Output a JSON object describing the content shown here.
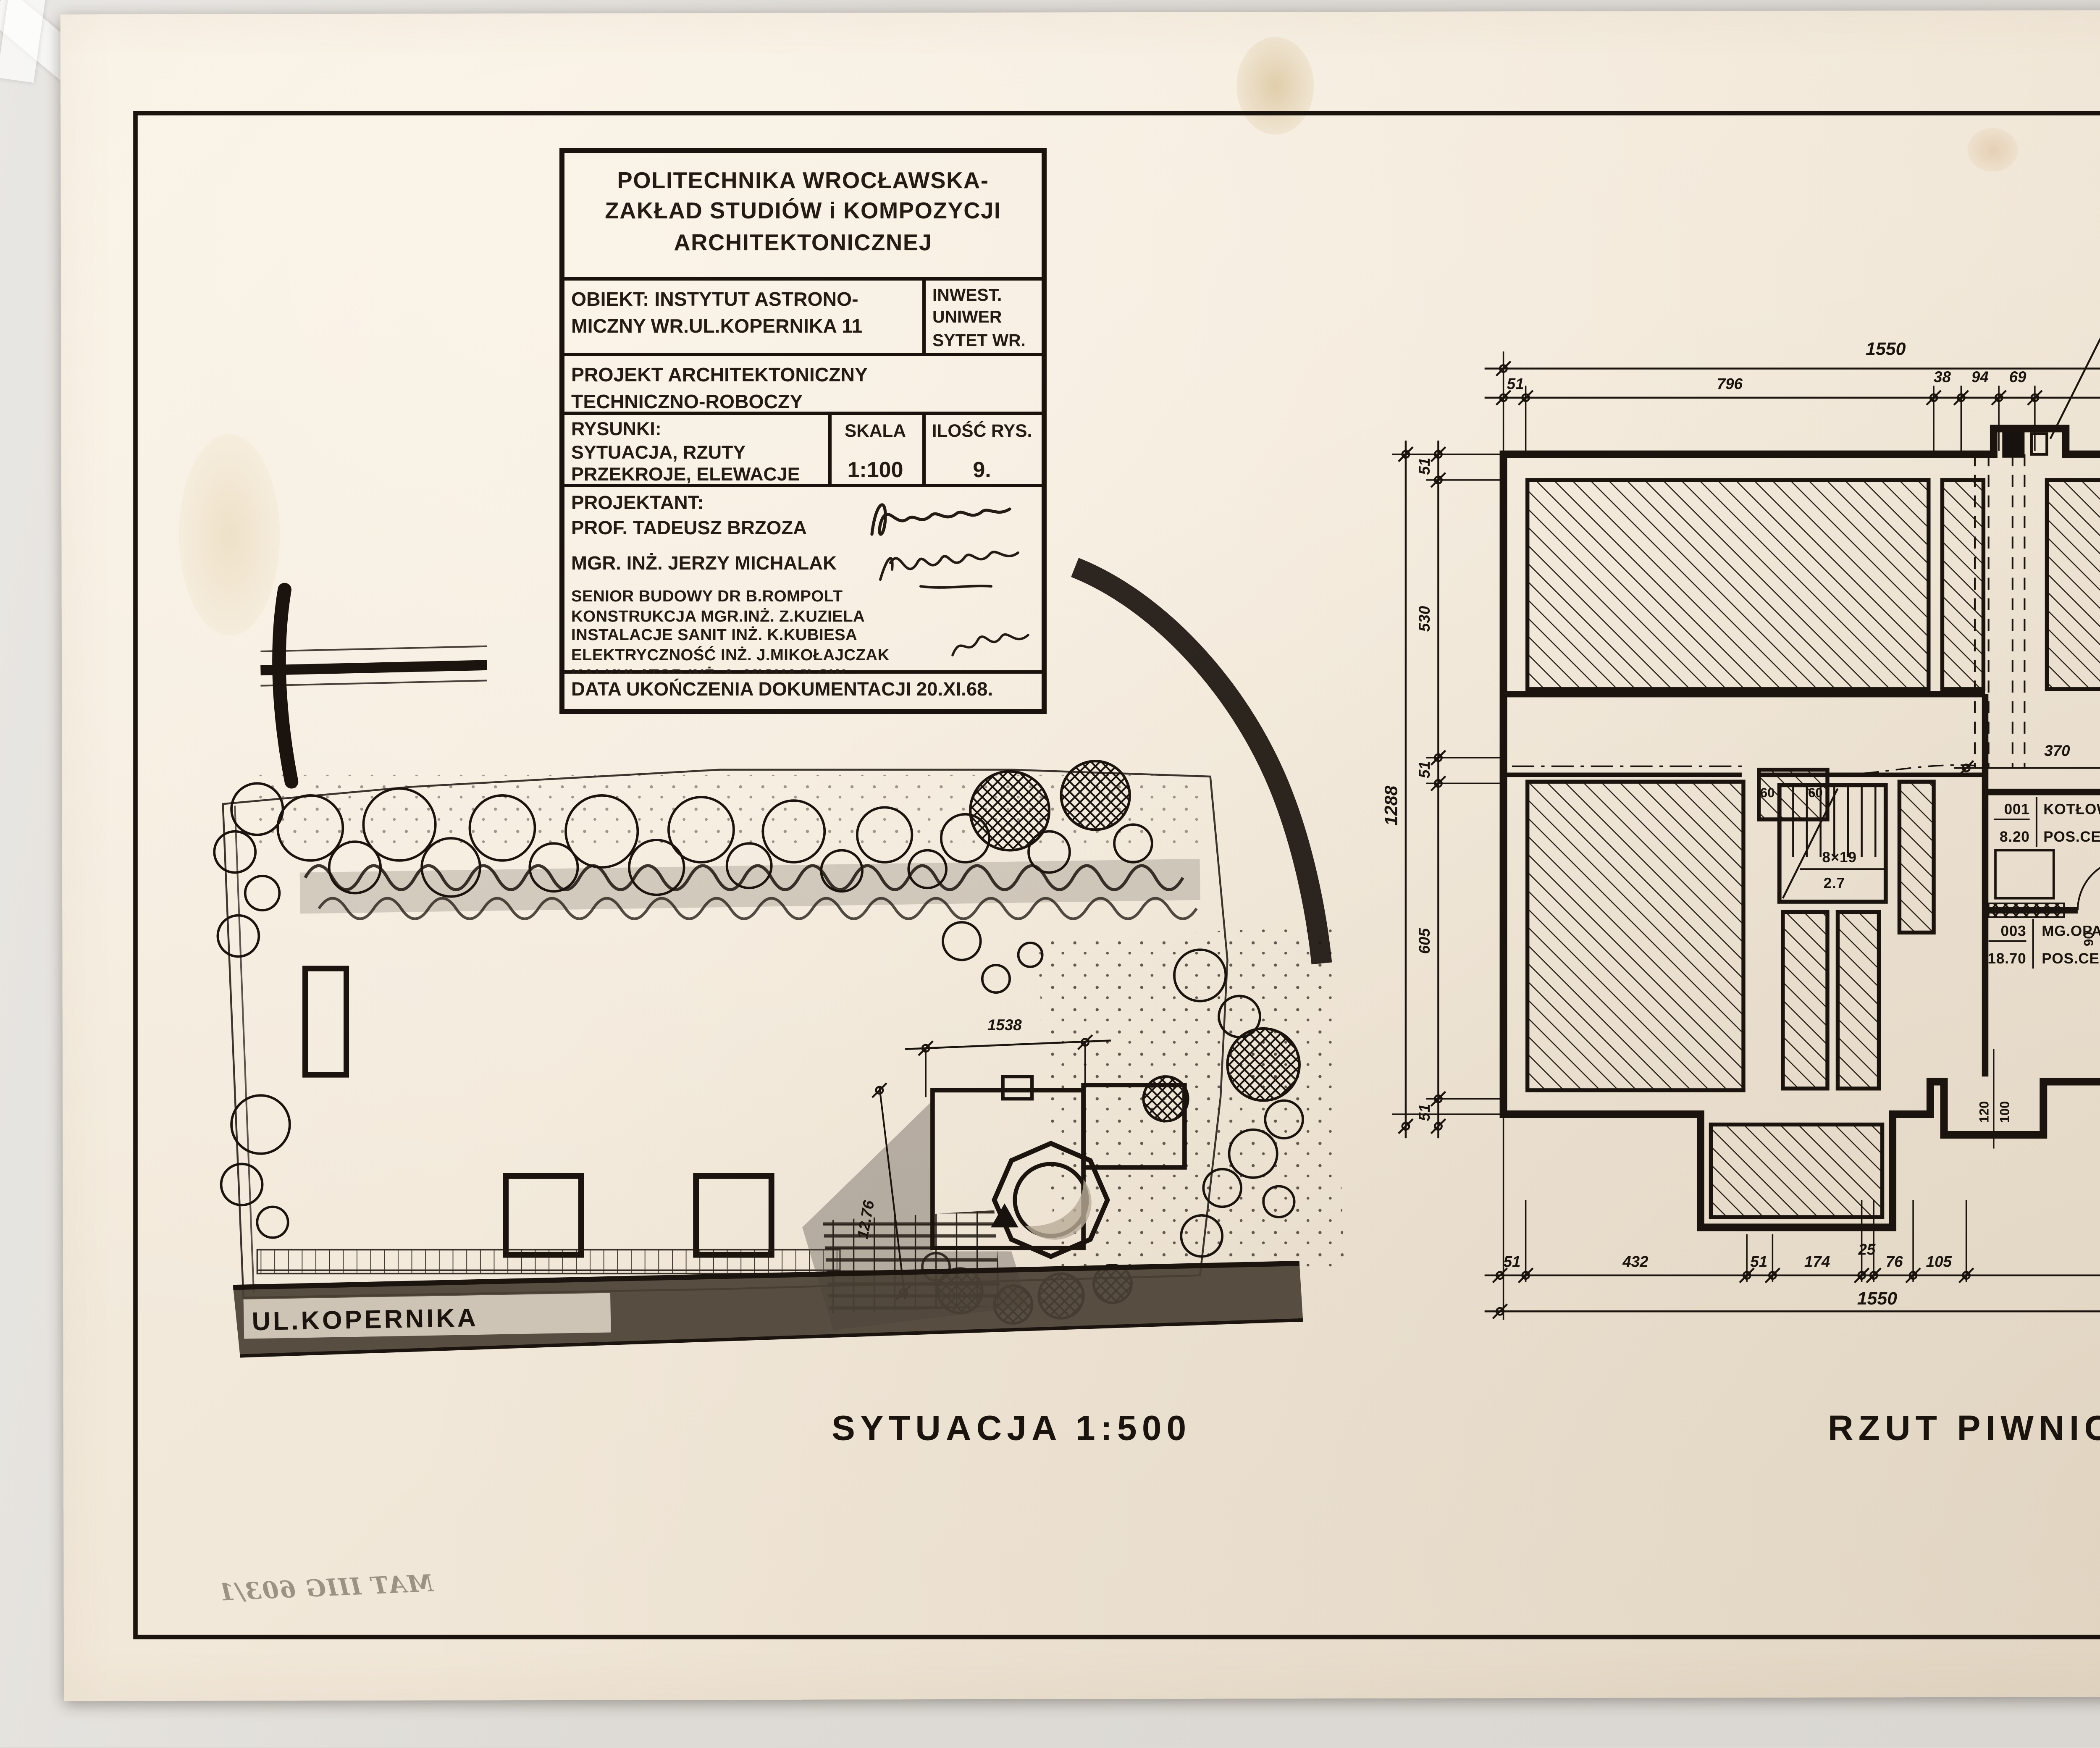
{
  "sheet": {
    "drawing_number": "RYS. NR. 1",
    "inventory_note": "MAT IIIG 603/1"
  },
  "title_block": {
    "institution_line1": "POLITECHNIKA WROCŁAWSKA-",
    "institution_line2": "ZAKŁAD STUDIÓW i KOMPOZYCJI",
    "institution_line3": "ARCHITEKTONICZNEJ",
    "object_line1": "OBIEKT: INSTYTUT ASTRONO-",
    "object_line2": "MICZNY WR.UL.KOPERNIKA 11",
    "investor_line1": "INWEST.",
    "investor_line2": "UNIWER",
    "investor_line3": "SYTET WR.",
    "project_line1": "PROJEKT ARCHITEKTONICZNY",
    "project_line2": "TECHNICZNO-ROBOCZY",
    "drawings_label": "RYSUNKI:",
    "drawings_line1": "SYTUACJA, RZUTY",
    "drawings_line2": "PRZEKROJE, ELEWACJE",
    "scale_label": "SKALA",
    "scale_value": "1:100",
    "count_label": "ILOŚĆ RYS.",
    "count_value": "9.",
    "designer_label": "PROJEKTANT:",
    "designer_name": "PROF. TADEUSZ BRZOZA",
    "engineer_name": "MGR. INŻ. JERZY MICHALAK",
    "staff_line1": "SENIOR BUDOWY DR B.ROMPOLT",
    "staff_line2": "KONSTRUKCJA MGR.INŻ. Z.KUZIELA",
    "staff_line3": "INSTALACJE SANIT INŻ. K.KUBIESA",
    "staff_line4": "ELEKTRYCZNOŚĆ INŻ. J.MIKOŁAJCZAK",
    "staff_line5": "KALKULATOR INŻ. A. MICHAJŁOW",
    "date_line": "DATA UKOŃCZENIA DOKUMENTACJI 20.XI.68."
  },
  "site_plan": {
    "title": "SYTUACJA  1:500",
    "street_name": "UL.KOPERNIKA",
    "building_width_dim": "1538",
    "building_side_dim": "12.76"
  },
  "floor_plan": {
    "title": "RZUT  PIWNIC  1:100",
    "chimney_note": "KOMIN 20×77; WENTYLACJA 14×14",
    "vent_note": "NAWIEW 20×20",
    "dims_top_total": "1550",
    "dims_top": [
      "51",
      "796",
      "38",
      "94",
      "69",
      "451",
      "51"
    ],
    "dims_bottom": [
      "51",
      "432",
      "51",
      "174",
      "25",
      "76",
      "105",
      "586",
      "67"
    ],
    "dims_bottom_total": "1550",
    "dims_left": [
      "51",
      "530",
      "51",
      "605",
      "51"
    ],
    "dims_left_total": "1288",
    "dims_right": [
      "51",
      "486",
      "118",
      "222",
      "12",
      "320",
      "67"
    ],
    "dims_right_total": "1288",
    "interior_dims": [
      "370",
      "6.",
      "210"
    ],
    "rooms": [
      {
        "no": "001",
        "name": "KOTŁOWNIA",
        "area": "8.20",
        "floor": "POS.CEM."
      },
      {
        "no": "002",
        "name": "ZUZLOWNIA",
        "area": "4.60",
        "floor": "POS.CEM."
      },
      {
        "no": "003",
        "name": "MG.OPAŁU",
        "area": "18.70",
        "floor": "POS.CEM."
      }
    ],
    "stair_note_top": "8×19",
    "stair_note_bottom": "2.7",
    "door_note_top": "90",
    "door_note_bottom": "2.00",
    "window_note_top": "120",
    "window_note_bottom": "100",
    "duct_label_1": "60",
    "duct_label_2": "60"
  },
  "colors": {
    "paper": "#f1e7d8",
    "ink": "#1b140e",
    "pencil": "#877e70",
    "street_fill": "#4a4034"
  }
}
